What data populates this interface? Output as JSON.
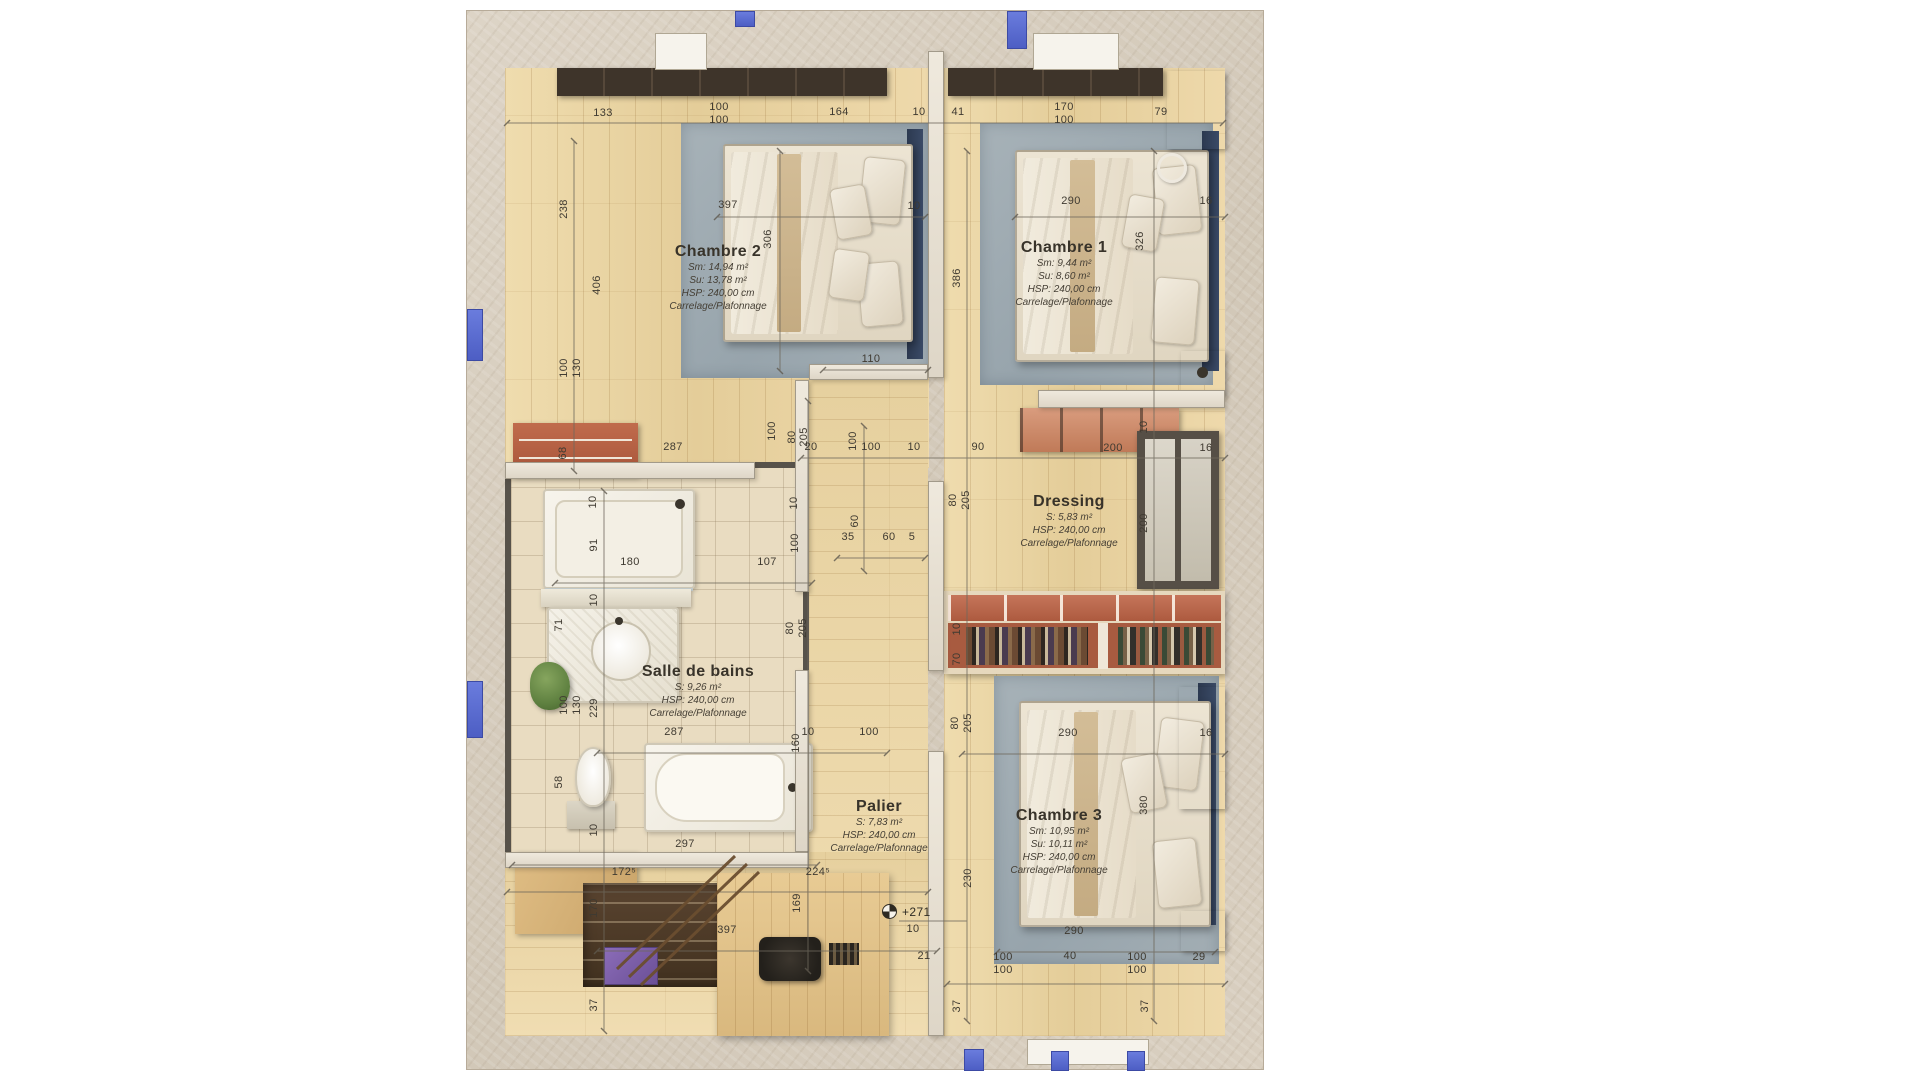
{
  "title": "Plan d'étage — rendu 3D",
  "rooms": {
    "chambre2": {
      "name": "Chambre 2",
      "l1": "Sm: 14,94 m²",
      "l2": "Su: 13,78 m²",
      "l3": "HSP: 240,00 cm",
      "l4": "Carrelage/Plafonnage"
    },
    "chambre1": {
      "name": "Chambre 1",
      "l1": "Sm: 9,44 m²",
      "l2": "Su: 8,60 m²",
      "l3": "HSP: 240,00 cm",
      "l4": "Carrelage/Plafonnage"
    },
    "dressing": {
      "name": "Dressing",
      "l1": "S: 5,83 m²",
      "l2": "HSP: 240,00 cm",
      "l3": "Carrelage/Plafonnage"
    },
    "bath": {
      "name": "Salle de bains",
      "l1": "S: 9,26 m²",
      "l2": "HSP: 240,00 cm",
      "l3": "Carrelage/Plafonnage"
    },
    "palier": {
      "name": "Palier",
      "l1": "S: 7,83 m²",
      "l2": "HSP: 240,00 cm",
      "l3": "Carrelage/Plafonnage"
    },
    "chambre3": {
      "name": "Chambre 3",
      "l1": "Sm: 10,95 m²",
      "l2": "Su: 10,11 m²",
      "l3": "HSP: 240,00 cm",
      "l4": "Carrelage/Plafonnage"
    }
  },
  "level_marker": "+271",
  "colors": {
    "window_blue": "#5c6fd3",
    "wood": "#ead5a5",
    "wall": "#d7cec0",
    "rug": "#9fabb2",
    "terracotta": "#b9674a"
  },
  "dimensions": [
    {
      "t": "133",
      "x": 136,
      "y": 102
    },
    {
      "t": "100",
      "x": 252,
      "y": 96
    },
    {
      "t": "100",
      "x": 252,
      "y": 109
    },
    {
      "t": "164",
      "x": 372,
      "y": 101
    },
    {
      "t": "10",
      "x": 452,
      "y": 101
    },
    {
      "t": "41",
      "x": 491,
      "y": 101
    },
    {
      "t": "170",
      "x": 597,
      "y": 96
    },
    {
      "t": "100",
      "x": 597,
      "y": 109
    },
    {
      "t": "79",
      "x": 694,
      "y": 101
    },
    {
      "t": "397",
      "x": 261,
      "y": 194
    },
    {
      "t": "10",
      "x": 447,
      "y": 195
    },
    {
      "t": "290",
      "x": 604,
      "y": 190
    },
    {
      "t": "16",
      "x": 739,
      "y": 190
    },
    {
      "t": "238",
      "x": 97,
      "y": 198,
      "r": 1
    },
    {
      "t": "306",
      "x": 301,
      "y": 228,
      "r": 1
    },
    {
      "t": "406",
      "x": 130,
      "y": 274,
      "r": 1
    },
    {
      "t": "326",
      "x": 673,
      "y": 230,
      "r": 1
    },
    {
      "t": "386",
      "x": 490,
      "y": 267,
      "r": 1
    },
    {
      "t": "110",
      "x": 404,
      "y": 348
    },
    {
      "t": "100",
      "x": 97,
      "y": 357,
      "r": 1
    },
    {
      "t": "130",
      "x": 110,
      "y": 357,
      "r": 1
    },
    {
      "t": "68",
      "x": 96,
      "y": 442,
      "r": 1
    },
    {
      "t": "287",
      "x": 206,
      "y": 436
    },
    {
      "t": "100",
      "x": 305,
      "y": 420,
      "r": 1
    },
    {
      "t": "20",
      "x": 344,
      "y": 436
    },
    {
      "t": "100",
      "x": 386,
      "y": 430,
      "r": 1
    },
    {
      "t": "100",
      "x": 404,
      "y": 436
    },
    {
      "t": "10",
      "x": 447,
      "y": 436
    },
    {
      "t": "90",
      "x": 511,
      "y": 436
    },
    {
      "t": "80",
      "x": 325,
      "y": 426,
      "r": 1
    },
    {
      "t": "205",
      "x": 337,
      "y": 426,
      "r": 1
    },
    {
      "t": "200",
      "x": 646,
      "y": 437
    },
    {
      "t": "16",
      "x": 739,
      "y": 437
    },
    {
      "t": "10",
      "x": 677,
      "y": 416,
      "r": 1
    },
    {
      "t": "200",
      "x": 677,
      "y": 512,
      "r": 1
    },
    {
      "t": "35",
      "x": 381,
      "y": 526
    },
    {
      "t": "60",
      "x": 388,
      "y": 510,
      "r": 1
    },
    {
      "t": "60",
      "x": 422,
      "y": 526
    },
    {
      "t": "5",
      "x": 445,
      "y": 526
    },
    {
      "t": "80",
      "x": 486,
      "y": 489,
      "r": 1
    },
    {
      "t": "205",
      "x": 499,
      "y": 489,
      "r": 1
    },
    {
      "t": "10",
      "x": 126,
      "y": 491,
      "r": 1
    },
    {
      "t": "91",
      "x": 127,
      "y": 534,
      "r": 1
    },
    {
      "t": "180",
      "x": 163,
      "y": 551
    },
    {
      "t": "107",
      "x": 300,
      "y": 551
    },
    {
      "t": "100",
      "x": 328,
      "y": 532,
      "r": 1
    },
    {
      "t": "10",
      "x": 327,
      "y": 492,
      "r": 1
    },
    {
      "t": "71",
      "x": 92,
      "y": 614,
      "r": 1
    },
    {
      "t": "10",
      "x": 127,
      "y": 589,
      "r": 1
    },
    {
      "t": "80",
      "x": 323,
      "y": 617,
      "r": 1
    },
    {
      "t": "205",
      "x": 336,
      "y": 617,
      "r": 1
    },
    {
      "t": "229",
      "x": 127,
      "y": 697,
      "r": 1
    },
    {
      "t": "100",
      "x": 97,
      "y": 694,
      "r": 1
    },
    {
      "t": "130",
      "x": 110,
      "y": 694,
      "r": 1
    },
    {
      "t": "287",
      "x": 207,
      "y": 721
    },
    {
      "t": "10",
      "x": 341,
      "y": 721
    },
    {
      "t": "160",
      "x": 329,
      "y": 732,
      "r": 1
    },
    {
      "t": "100",
      "x": 402,
      "y": 721
    },
    {
      "t": "58",
      "x": 92,
      "y": 771,
      "r": 1
    },
    {
      "t": "10",
      "x": 127,
      "y": 819,
      "r": 1
    },
    {
      "t": "297",
      "x": 218,
      "y": 833
    },
    {
      "t": "172⁵",
      "x": 157,
      "y": 861
    },
    {
      "t": "224⁵",
      "x": 351,
      "y": 861
    },
    {
      "t": "10",
      "x": 490,
      "y": 618,
      "r": 1
    },
    {
      "t": "70",
      "x": 490,
      "y": 648,
      "r": 1
    },
    {
      "t": "80",
      "x": 488,
      "y": 712,
      "r": 1
    },
    {
      "t": "205",
      "x": 501,
      "y": 712,
      "r": 1
    },
    {
      "t": "290",
      "x": 601,
      "y": 722
    },
    {
      "t": "16",
      "x": 739,
      "y": 722
    },
    {
      "t": "380",
      "x": 677,
      "y": 794,
      "r": 1
    },
    {
      "t": "230",
      "x": 501,
      "y": 867,
      "r": 1
    },
    {
      "t": "170",
      "x": 127,
      "y": 897,
      "r": 1
    },
    {
      "t": "397",
      "x": 260,
      "y": 919
    },
    {
      "t": "169",
      "x": 330,
      "y": 892,
      "r": 1
    },
    {
      "t": "10",
      "x": 446,
      "y": 918
    },
    {
      "t": "21",
      "x": 457,
      "y": 945
    },
    {
      "t": "290",
      "x": 607,
      "y": 920
    },
    {
      "t": "100",
      "x": 536,
      "y": 946
    },
    {
      "t": "100",
      "x": 536,
      "y": 959
    },
    {
      "t": "40",
      "x": 603,
      "y": 945
    },
    {
      "t": "100",
      "x": 670,
      "y": 946
    },
    {
      "t": "100",
      "x": 670,
      "y": 959
    },
    {
      "t": "29",
      "x": 732,
      "y": 946
    },
    {
      "t": "37",
      "x": 127,
      "y": 994,
      "r": 1
    },
    {
      "t": "37",
      "x": 490,
      "y": 995,
      "r": 1
    },
    {
      "t": "37",
      "x": 678,
      "y": 995,
      "r": 1
    }
  ]
}
